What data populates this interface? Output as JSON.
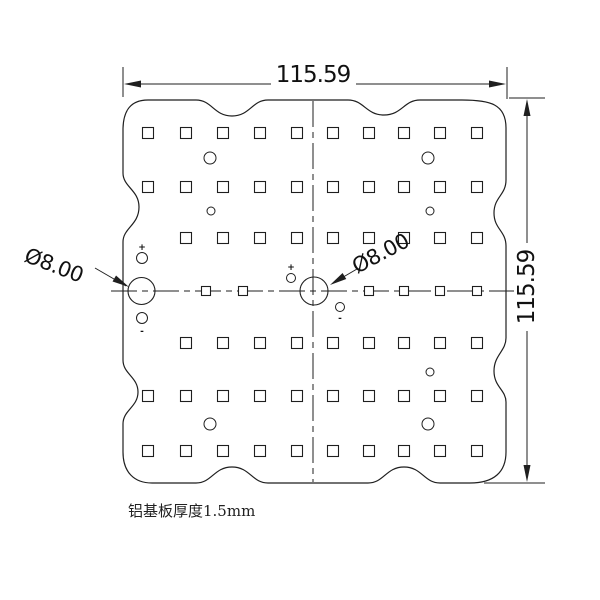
{
  "drawing": {
    "dim_width": "115.59",
    "dim_height": "115.59",
    "hole_callout_left": "Ø8.00",
    "hole_callout_right": "Ø8.00",
    "note": "铝基板厚度1.5mm",
    "colors": {
      "line": "#1f1f1f",
      "background": "#ffffff"
    },
    "pad_grid": {
      "pad_size": 11,
      "columns": [
        148,
        186,
        223,
        260,
        297,
        333,
        369,
        404,
        440,
        477
      ],
      "rows": [
        {
          "y": 133,
          "from": 0
        },
        {
          "y": 187,
          "from": 0
        },
        {
          "y": 238,
          "from": 1
        },
        {
          "y": 343,
          "from": 1
        },
        {
          "y": 396,
          "from": 0
        },
        {
          "y": 451,
          "from": 0
        }
      ],
      "center_row": {
        "y": 291,
        "size": 9,
        "x": [
          206,
          243,
          369,
          404,
          440,
          477
        ]
      }
    },
    "small_holes": [
      {
        "x": 210,
        "y": 158,
        "r": 6
      },
      {
        "x": 428,
        "y": 158,
        "r": 6
      },
      {
        "x": 211,
        "y": 211,
        "r": 4
      },
      {
        "x": 430,
        "y": 211,
        "r": 4
      },
      {
        "x": 142,
        "y": 258,
        "r": 5.5
      },
      {
        "x": 291,
        "y": 278,
        "r": 4.5
      },
      {
        "x": 340,
        "y": 307,
        "r": 4.5
      },
      {
        "x": 142,
        "y": 318,
        "r": 5.5
      },
      {
        "x": 430,
        "y": 372,
        "r": 4
      },
      {
        "x": 210,
        "y": 424,
        "r": 6
      },
      {
        "x": 428,
        "y": 424,
        "r": 6
      }
    ],
    "polarity_marks": [
      {
        "x": 142,
        "y": 250,
        "t": "+"
      },
      {
        "x": 291,
        "y": 270,
        "t": "+"
      },
      {
        "x": 340,
        "y": 321,
        "t": "-"
      },
      {
        "x": 142,
        "y": 334,
        "t": "-"
      }
    ],
    "mounting_holes": [
      {
        "cx": 141.5,
        "cy": 291,
        "r": 13.5
      },
      {
        "cx": 314,
        "cy": 291,
        "r": 14
      }
    ]
  }
}
